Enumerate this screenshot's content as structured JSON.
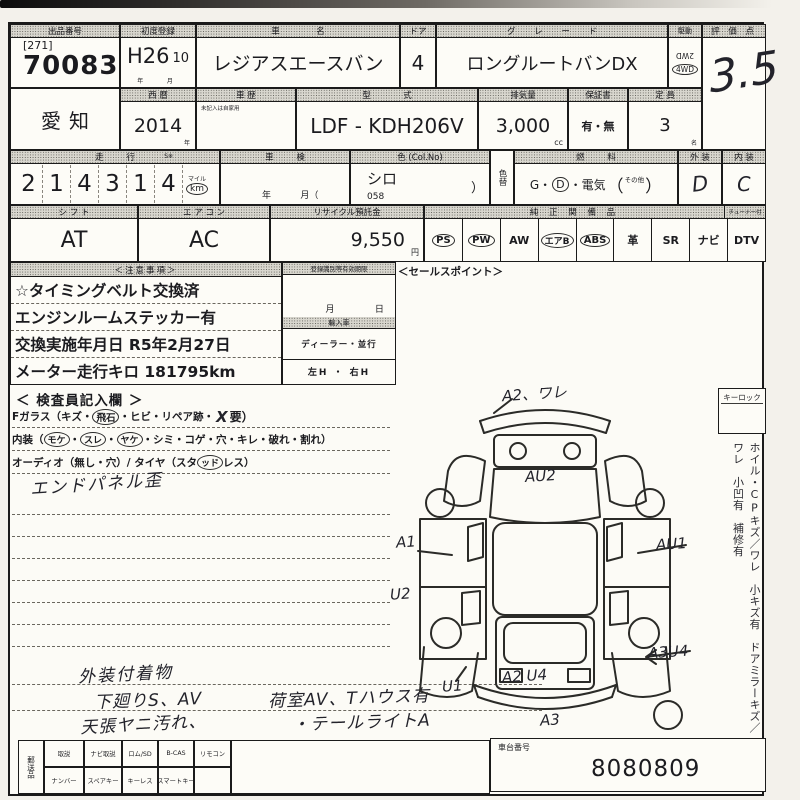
{
  "sheet": {
    "row1": {
      "auction_no_label": "出品番号",
      "auction_no_bracket": "[271]",
      "auction_no": "70083",
      "first_reg_label": "初度登録",
      "first_reg_year": "H26",
      "first_reg_month": "10",
      "first_reg_unit_year": "年",
      "first_reg_unit_month": "月",
      "car_name_label": "車　名",
      "car_name": "レジアスエースバン",
      "doors_label": "ドア",
      "doors": "4",
      "grade_label": "グ レ ー ド",
      "grade": "ロングルートバンDX",
      "drive_label": "駆動",
      "drive_option1": "2WD",
      "drive_option2": "4WD",
      "score_label": "評 価 点",
      "score": "3.5"
    },
    "row2": {
      "region": "愛知",
      "year_label": "西 暦",
      "year": "2014",
      "year_unit": "年",
      "history_label": "車 歴",
      "history_note": "未記入は自家用",
      "model_label": "型　式",
      "model": "LDF - KDH206V",
      "disp_label": "排気量",
      "disp": "3,000",
      "disp_unit": "cc",
      "warranty_label": "保証書",
      "warranty": "有・無",
      "capacity_label": "定 員",
      "capacity": "3",
      "capacity_unit": "名"
    },
    "row3": {
      "mileage_label": "走 行",
      "mileage_s": "S※",
      "digits": [
        "2",
        "1",
        "4",
        "3",
        "1",
        "4"
      ],
      "unit_mile": "マイル",
      "unit_km": "km",
      "shaken_label": "車 検",
      "shaken_year": "年",
      "shaken_month": "月（",
      "color_label": "色 (Col.No)",
      "color": "シロ",
      "color_no": "058",
      "color_paren": "）",
      "color_change": "色替",
      "fuel_label": "燃 料",
      "fuel_g": "G・",
      "fuel_d": "D",
      "fuel_rest": "・電気",
      "paren_open": "（",
      "fuel_other": "その他",
      "paren_close": "）",
      "ext_label": "外 装",
      "ext": "D",
      "int_label": "内 装",
      "int": "C"
    },
    "row4": {
      "shift_label": "シ フ ト",
      "shift": "AT",
      "aircon_label": "エ ア コ ン",
      "aircon": "AC",
      "recycle_label": "リサイクル預託金",
      "recycle": "9,550",
      "recycle_unit": "円",
      "equip_label": "純 正 関 備 品",
      "tuner_label": "チューナー付",
      "equipment": [
        {
          "label": "PS",
          "circled": true
        },
        {
          "label": "PW",
          "circled": true
        },
        {
          "label": "AW",
          "circled": false
        },
        {
          "label": "エアB",
          "circled": true
        },
        {
          "label": "ABS",
          "circled": true
        },
        {
          "label": "革",
          "circled": false
        },
        {
          "label": "SR",
          "circled": false
        },
        {
          "label": "ナビ",
          "circled": false
        },
        {
          "label": "DTV",
          "circled": false
        }
      ]
    },
    "notes": {
      "header": "＜注意事項＞",
      "lines": [
        "☆タイミングベルト交換済",
        "エンジンルームステッカー有",
        "交換実施年月日 R5年2月27日",
        "メーター走行キロ 181795km"
      ]
    },
    "reg_box": {
      "header": "登録識別等有効期限",
      "month": "月",
      "day": "日",
      "import_header": "輸入車",
      "import_type": "ディーラー・並行",
      "handle": "左H ・ 右H"
    },
    "sales_point": "＜セールスポイント＞",
    "inspector": {
      "header": "＜ 検査員記入欄 ＞",
      "fglass_pre": "Fガラス（キズ・",
      "fglass_circled": "飛石",
      "fglass_mid": "・ヒビ・リペア跡・",
      "fglass_x": "X",
      "fglass_post": "要）",
      "interior_pre": "内装（",
      "interior_c1": "モケ",
      "interior_d1": "・",
      "interior_c2": "スレ",
      "interior_d2": "・",
      "interior_c3": "ヤケ",
      "interior_post": "・シミ・コゲ・穴・キレ・破れ・割れ）",
      "audio_pre": "オーディオ（無し・穴）/ タイヤ（スタ",
      "audio_circled": "ッド",
      "audio_post": "レス）",
      "hw_panel": "エンドパネル歪",
      "hw_b1": "外装付着物",
      "hw_b2": "下廻りS、AV",
      "hw_b3": "荷室AV、Tハウス有",
      "hw_b4": "天張ヤニ汚れ、",
      "hw_b5": "・テールライトA"
    },
    "diagram": {
      "annotations": [
        "A2、ワレ",
        "AU2",
        "A1",
        "AU1",
        "U2",
        "A3U4",
        "U1",
        "A2 U4",
        "A3"
      ]
    },
    "right_col": {
      "keylock": "キーロック",
      "vertical_note": "ホイル・CPキズ／ワレ　小キズ有　ドアミラーキズ／ワレ　小凹有　補修有"
    },
    "bottom": {
      "mail_label": "郵送品",
      "row1": [
        "取説",
        "ナビ取説",
        "ロム/SD",
        "B-CAS",
        "リモコン"
      ],
      "row2": [
        "ナンバー",
        "スペアキー",
        "キーレス",
        "スマートキー"
      ],
      "chassis_label": "車台番号",
      "chassis_no": "8080809"
    }
  }
}
